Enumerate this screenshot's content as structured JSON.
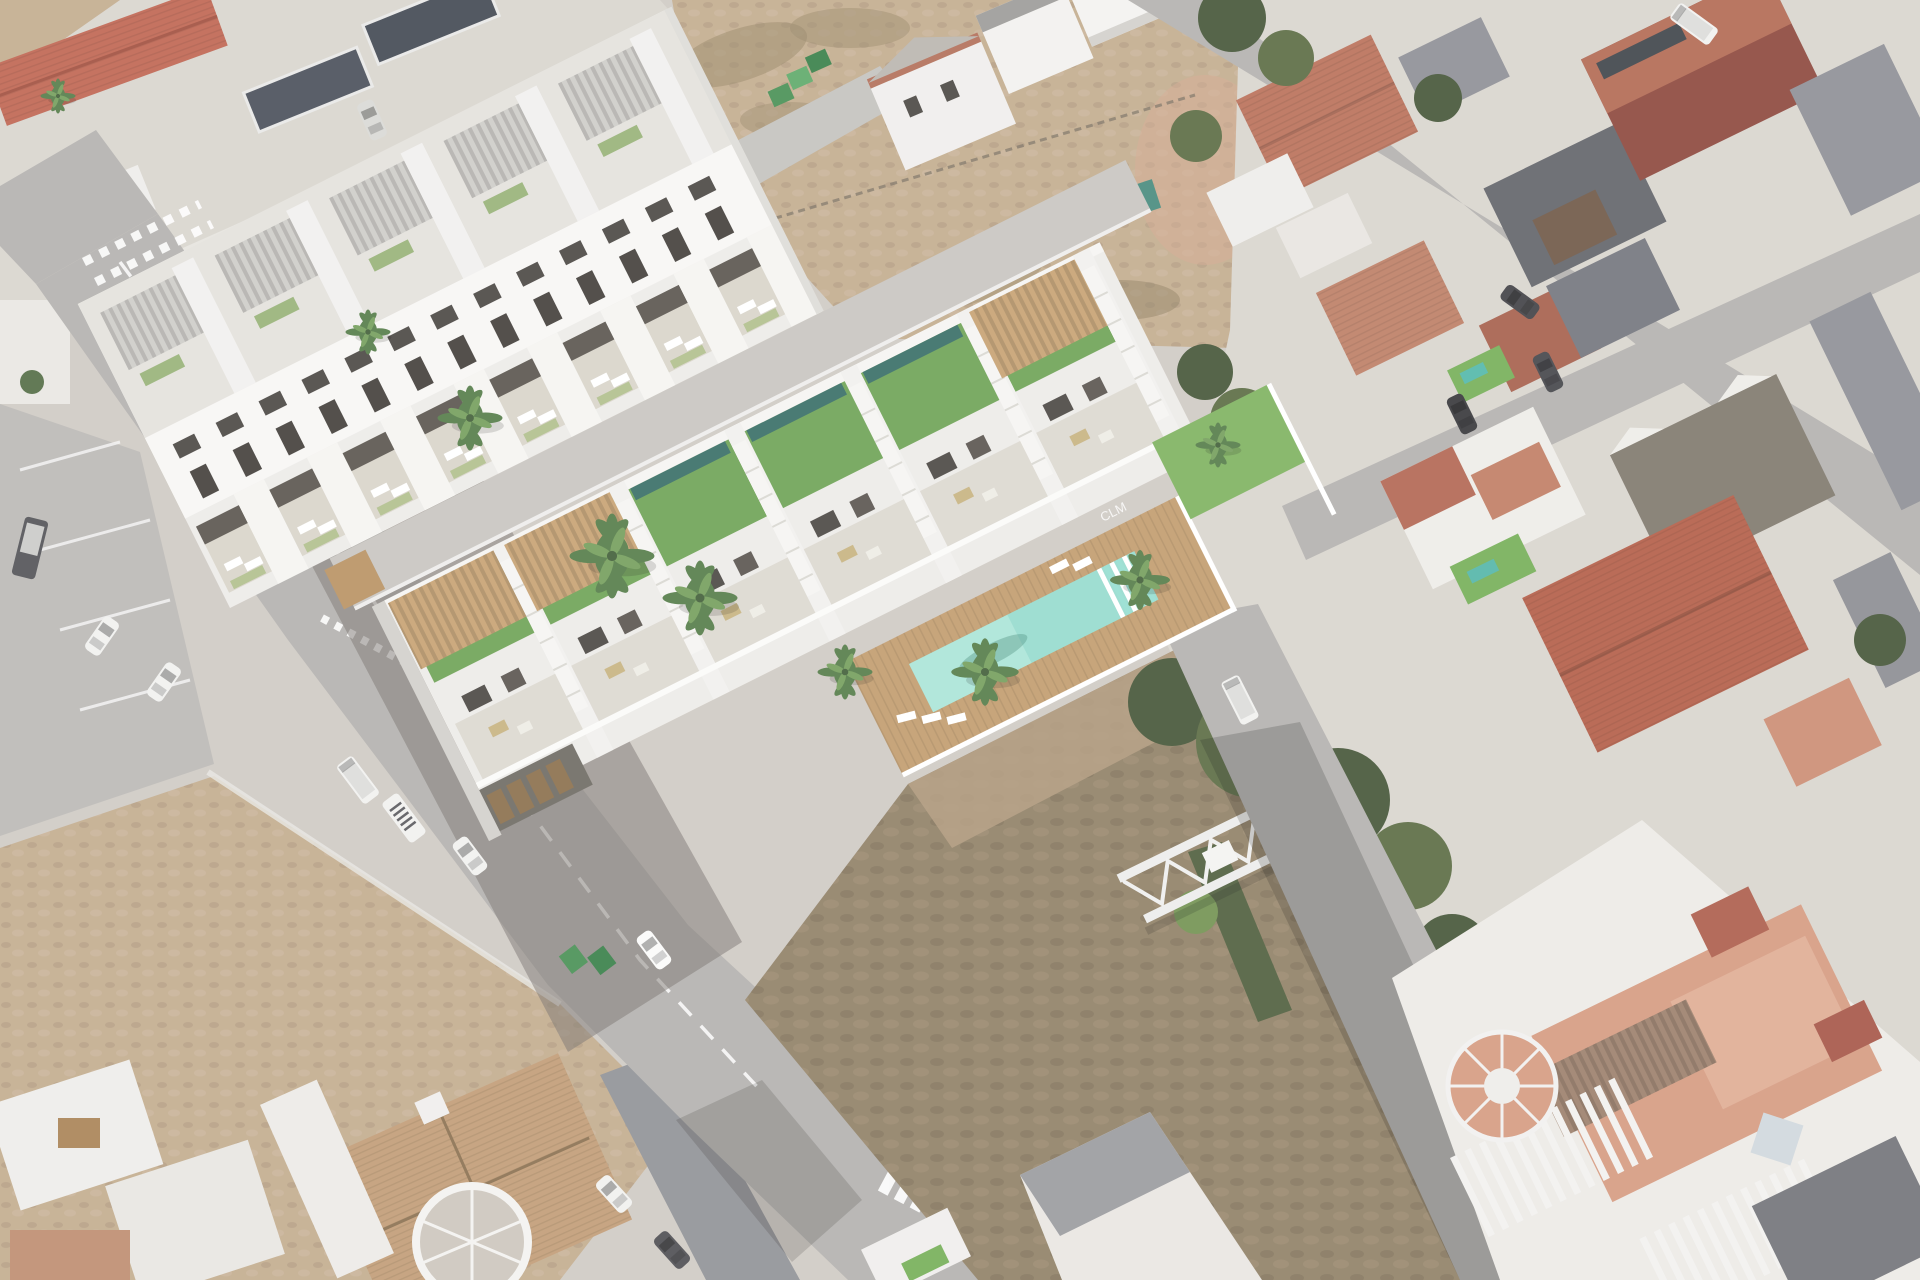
{
  "meta": {
    "title": "Aerial 3D render of a new-build townhouse development composited onto an oblique aerial photo of a Spanish town",
    "view": "oblique aerial view",
    "image_width": 1920,
    "image_height": 1280
  },
  "palette": {
    "haze_base": "#cfc9c2",
    "road": "#b2b0ad",
    "lane": "#c7c4bf",
    "facade_white": "#f7f6f3",
    "render_white": "#edebe7",
    "window_dark": "#47423e",
    "grass_roof": "#68a24d",
    "plunge_pool": "#2f6b63",
    "pergola_wood": "#c9a06b",
    "deck_wood": "#c49a67",
    "pool_water": "#8fdccc",
    "pool_water_light": "#aee8da",
    "lawn_green": "#79b257",
    "astro_green": "#6fae4e",
    "courtyard_pool": "#4ab6a6",
    "dirt_light": "#c4aa89",
    "scrub_dark": "#8f7d60",
    "terracotta": "#bd6b52",
    "terracotta_light": "#c07b5f",
    "tile_red": "#b5614c",
    "brick_dark": "#8e4136",
    "salmon_roof": "#b7583f",
    "salmon_terrace": "#d9977b",
    "roof_gray": "#8c8d93",
    "roof_charcoal": "#5e6067",
    "roof_brown_gray": "#7d7568",
    "tan_tile_roof": "#c39a6f",
    "tree_green": "#3f5230",
    "tree_green_light": "#55693c",
    "car_white": "#f2f2f0",
    "car_dark": "#3c3c40",
    "bin_green": "#3f8f4d",
    "truss_white": "#ededeb",
    "shadow": "#6f6a63"
  },
  "scene": {
    "development": {
      "name": "new-build residential development (3D render)",
      "townhouse_units": 6,
      "apartment_terrace_units": 8,
      "green_roofs": 6,
      "rooftop_plunge_pools": 6,
      "wood_pergolas": 3,
      "external_staircases": 6,
      "communal_pool": {
        "shape": "rectangular",
        "steps_visible": true,
        "water_color": "#8fdccc"
      },
      "sun_loungers_visible": 21,
      "palm_trees": 9,
      "wall_letters": "CLM"
    },
    "streets": {
      "dashed_centerline": true,
      "give_way_markings": true,
      "zebra_crossing": true,
      "vehicles_visible": 14,
      "green_dumpsters": 5
    },
    "surroundings": {
      "vacant_dirt_lots": 3,
      "steel_truss_structures": 2,
      "town_roof_types": [
        "terracotta",
        "gray-slate",
        "salmon",
        "tan-tile",
        "brick-red"
      ],
      "rooftop_terraces": true,
      "round_turret_terraces": 2,
      "trees_visible": 14
    }
  }
}
